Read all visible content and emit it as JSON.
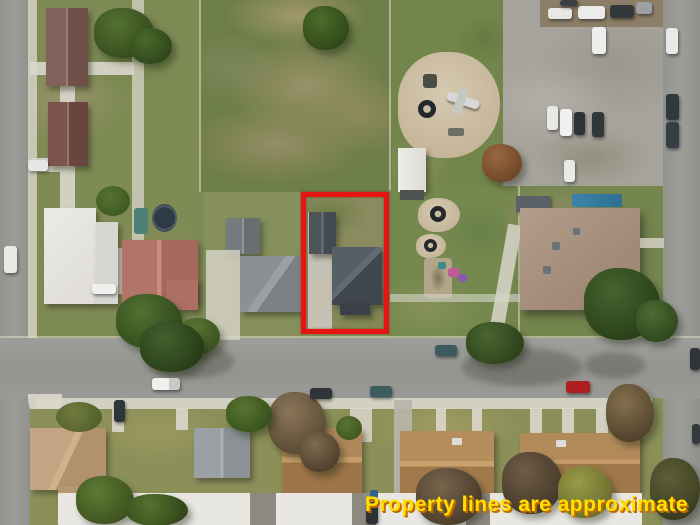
{
  "overlay": {
    "disclaimer": "Property lines are approximate",
    "disclaimer_color": "#FFE000",
    "disclaimer_shadow_color": "#BF6B00",
    "boundary_color": "#E41513"
  },
  "scene": {
    "type": "aerial-drone-photo",
    "subject": "residential parcel outlined in red containing a house, detached garage and driveway",
    "visible_features": [
      "vacant patchy grass field",
      "playground sand pit with airplane climber and tire planters",
      "white storage shed",
      "gravel parking lot with parked cars",
      "horizontal residential street with parked pickup and cars",
      "vertical streets on left and right edges",
      "single-family homes with brown, salmon, white and gray roofs",
      "large flat-roof building with rooftop vents and blue pool cover",
      "row of tan-roofed townhouses along the bottom",
      "trees, lawns and sidewalks"
    ]
  }
}
